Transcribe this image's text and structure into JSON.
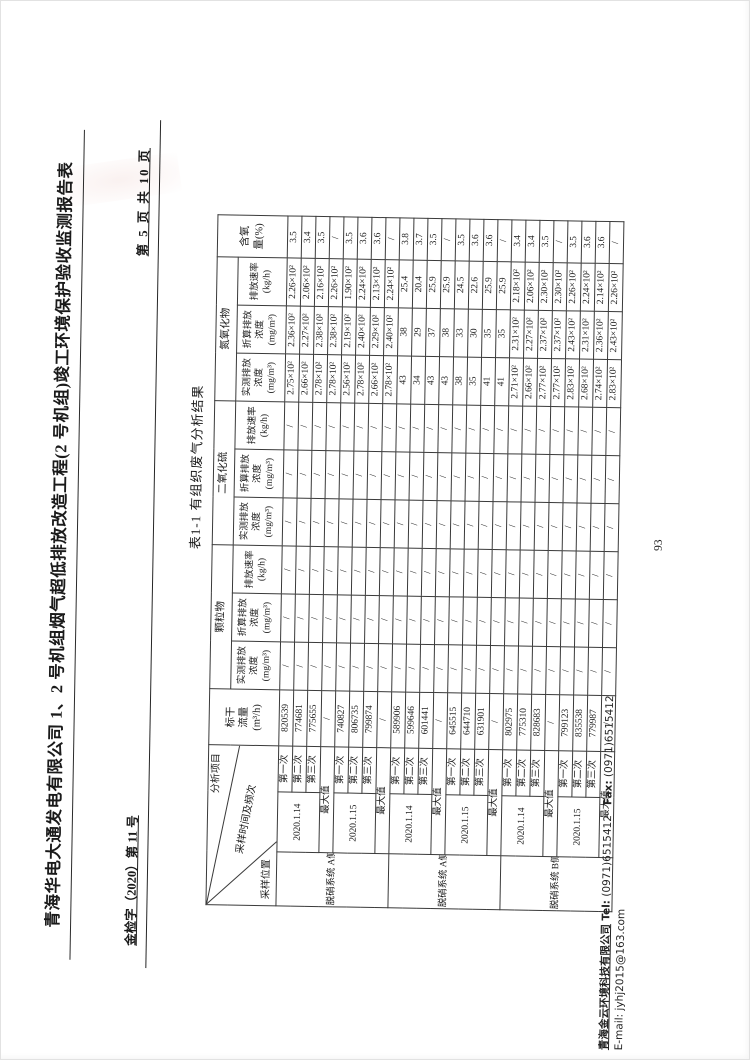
{
  "header": {
    "doc_number": "金检字（2020）第 11 号",
    "title": "青海华电大通发电有限公司 1、2 号机组烟气超低排放改造工程(2 号机组)竣工环境保护验收监测报告表",
    "page_info": "第 5 页 共 10 页"
  },
  "table": {
    "title": "表1-1  有组织废气分析结果",
    "corner": {
      "top": "分析项目",
      "middle": "采样时间及频次",
      "bottom": "采样位置"
    },
    "headers": {
      "flow": "标干\n流量\n(m³/h)",
      "groups": [
        {
          "name": "颗粒物",
          "subs": [
            "实测排放\n浓度\n(mg/m³)",
            "折算排放\n浓度\n(mg/m³)",
            "排放速率\n(kg/h)"
          ]
        },
        {
          "name": "二氧化硫",
          "subs": [
            "实测排放\n浓度\n(mg/m³)",
            "折算排放\n浓度\n(mg/m³)",
            "排放速率\n(kg/h)"
          ]
        },
        {
          "name": "氮氧化物",
          "subs": [
            "实测排放\n浓度\n(mg/m³)",
            "折算排放\n浓度\n(mg/m³)",
            "排放速率\n(kg/h)"
          ]
        }
      ],
      "oxygen": "含氧\n量(%)"
    },
    "rows": [
      [
        {
          "t": "脱硝系统\nA侧进口",
          "rs": 8,
          "cls": "loc",
          "n": "location-cell"
        },
        {
          "t": "2020.1.14",
          "rs": 3,
          "n": "date-cell"
        },
        "第一次",
        "820539",
        "/",
        "/",
        "/",
        "/",
        "/",
        "/",
        "2.75×10²",
        "2.36×10²",
        "2.26×10²",
        "3.5"
      ],
      [
        "第二次",
        "774681",
        "/",
        "/",
        "/",
        "/",
        "/",
        "/",
        "2.66×10²",
        "2.27×10²",
        "2.06×10²",
        "3.4"
      ],
      [
        "第三次",
        "775655",
        "/",
        "/",
        "/",
        "/",
        "/",
        "/",
        "2.78×10²",
        "2.38×10²",
        "2.16×10²",
        "3.5"
      ],
      [
        {
          "t": "最大值",
          "cs": 2,
          "n": "max-label-cell"
        },
        "/",
        "/",
        "/",
        "/",
        "/",
        "/",
        "/",
        "2.78×10²",
        "2.38×10²",
        "2.26×10²",
        "/"
      ],
      [
        {
          "t": "2020.1.15",
          "rs": 3,
          "n": "date-cell"
        },
        "第一次",
        "740827",
        "/",
        "/",
        "/",
        "/",
        "/",
        "/",
        "2.56×10²",
        "2.19×10²",
        "1.90×10²",
        "3.5"
      ],
      [
        "第二次",
        "806735",
        "/",
        "/",
        "/",
        "/",
        "/",
        "/",
        "2.78×10²",
        "2.40×10²",
        "2.24×10²",
        "3.6"
      ],
      [
        "第三次",
        "799874",
        "/",
        "/",
        "/",
        "/",
        "/",
        "/",
        "2.66×10²",
        "2.29×10²",
        "2.13×10²",
        "3.6"
      ],
      [
        {
          "t": "最大值",
          "cs": 2,
          "n": "max-label-cell"
        },
        "/",
        "/",
        "/",
        "/",
        "/",
        "/",
        "/",
        "2.78×10²",
        "2.40×10²",
        "2.24×10²",
        "/"
      ],
      [
        {
          "t": "脱硝系统\nA侧出口",
          "rs": 8,
          "cls": "loc",
          "n": "location-cell"
        },
        {
          "t": "2020.1.14",
          "rs": 3,
          "n": "date-cell"
        },
        "第一次",
        "589906",
        "/",
        "/",
        "/",
        "/",
        "/",
        "/",
        "43",
        "38",
        "25.4",
        "3.8"
      ],
      [
        "第二次",
        "599646",
        "/",
        "/",
        "/",
        "/",
        "/",
        "/",
        "34",
        "29",
        "20.4",
        "3.7"
      ],
      [
        "第三次",
        "601441",
        "/",
        "/",
        "/",
        "/",
        "/",
        "/",
        "43",
        "37",
        "25.9",
        "3.5"
      ],
      [
        {
          "t": "最大值",
          "cs": 2,
          "n": "max-label-cell"
        },
        "/",
        "/",
        "/",
        "/",
        "/",
        "/",
        "/",
        "43",
        "38",
        "25.9",
        "/"
      ],
      [
        {
          "t": "2020.1.15",
          "rs": 3,
          "n": "date-cell"
        },
        "第一次",
        "645515",
        "/",
        "/",
        "/",
        "/",
        "/",
        "/",
        "38",
        "33",
        "24.5",
        "3.5"
      ],
      [
        "第二次",
        "644710",
        "/",
        "/",
        "/",
        "/",
        "/",
        "/",
        "35",
        "30",
        "22.6",
        "3.6"
      ],
      [
        "第三次",
        "631901",
        "/",
        "/",
        "/",
        "/",
        "/",
        "/",
        "41",
        "35",
        "25.9",
        "3.6"
      ],
      [
        {
          "t": "最大值",
          "cs": 2,
          "n": "max-label-cell"
        },
        "/",
        "/",
        "/",
        "/",
        "/",
        "/",
        "/",
        "41",
        "35",
        "25.9",
        "/"
      ],
      [
        {
          "t": "脱硝系统\nB侧进口",
          "rs": 8,
          "cls": "loc",
          "n": "location-cell"
        },
        {
          "t": "2020.1.14",
          "rs": 3,
          "n": "date-cell"
        },
        "第一次",
        "802975",
        "/",
        "/",
        "/",
        "/",
        "/",
        "/",
        "2.71×10²",
        "2.31×10²",
        "2.18×10²",
        "3.4"
      ],
      [
        "第二次",
        "775310",
        "/",
        "/",
        "/",
        "/",
        "/",
        "/",
        "2.66×10²",
        "2.27×10²",
        "2.06×10²",
        "3.4"
      ],
      [
        "第三次",
        "828683",
        "/",
        "/",
        "/",
        "/",
        "/",
        "/",
        "2.77×10²",
        "2.37×10²",
        "2.30×10²",
        "3.5"
      ],
      [
        {
          "t": "最大值",
          "cs": 2,
          "n": "max-label-cell"
        },
        "/",
        "/",
        "/",
        "/",
        "/",
        "/",
        "/",
        "2.77×10²",
        "2.37×10²",
        "2.30×10²",
        "/"
      ],
      [
        {
          "t": "2020.1.15",
          "rs": 3,
          "n": "date-cell"
        },
        "第一次",
        "799123",
        "/",
        "/",
        "/",
        "/",
        "/",
        "/",
        "2.83×10²",
        "2.43×10²",
        "2.26×10²",
        "3.5"
      ],
      [
        "第二次",
        "835538",
        "/",
        "/",
        "/",
        "/",
        "/",
        "/",
        "2.68×10²",
        "2.31×10²",
        "2.24×10²",
        "3.6"
      ],
      [
        "第三次",
        "779987",
        "/",
        "/",
        "/",
        "/",
        "/",
        "/",
        "2.74×10²",
        "2.36×10²",
        "2.14×10²",
        "3.6"
      ],
      [
        {
          "t": "最大值",
          "cs": 2,
          "n": "max-label-cell"
        },
        "/",
        "/",
        "/",
        "/",
        "/",
        "/",
        "/",
        "2.83×10²",
        "2.43×10²",
        "2.26×10²",
        "/"
      ]
    ]
  },
  "footer": {
    "company": "青海金云环境科技有限公司",
    "tel_label": "Tel:",
    "tel": "(0971)6515412",
    "fax_label": "Fax:",
    "fax": "(0971)6515412",
    "email_label": "E-mail:",
    "email": "jyhj2015@163.com"
  },
  "page_number": "93"
}
